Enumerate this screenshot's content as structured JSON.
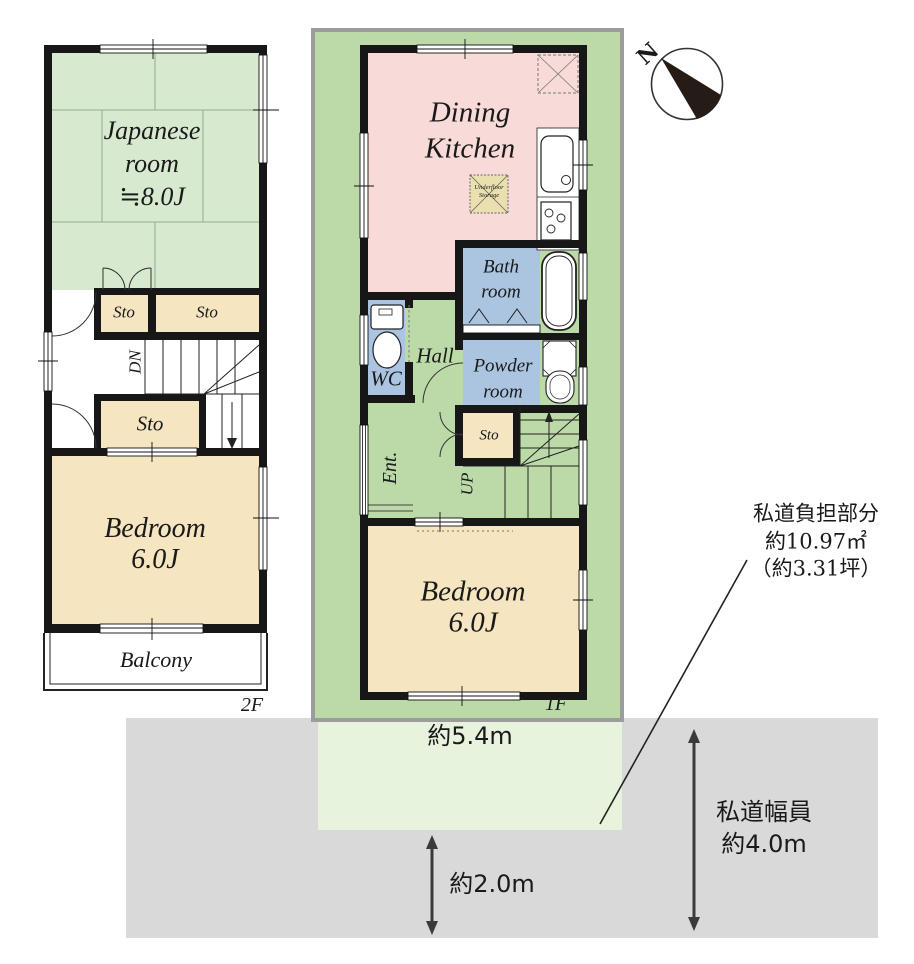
{
  "palette": {
    "tatami_green": "#d7e9cf",
    "lot_green": "#bcd9a8",
    "road_burden_green": "#e7f3dd",
    "room_tan": "#f5e5c1",
    "dining_pink": "#f8dbd8",
    "wet_area_blue": "#abc4e0",
    "road_gray": "#d9d9d9",
    "lot_border_gray": "#9c9c9c",
    "wall_black": "#171717"
  },
  "compass": {
    "north_label": "N"
  },
  "floor2": {
    "floor_label": "2F",
    "japanese_room": {
      "name_line1": "Japanese",
      "name_line2": "room",
      "size": "≒8.0J"
    },
    "storage_upper_left": "Sto",
    "storage_upper_right": "Sto",
    "storage_lower": "Sto",
    "stairs_down_label": "DN",
    "bedroom": {
      "name": "Bedroom",
      "size": "6.0J"
    },
    "balcony_label": "Balcony"
  },
  "floor1": {
    "floor_label": "1F",
    "dining_kitchen": {
      "name_line1": "Dining",
      "name_line2": "Kitchen"
    },
    "underfloor_storage": {
      "line1": "Underfloor",
      "line2": "Storage"
    },
    "bath_room": {
      "line1": "Bath",
      "line2": "room"
    },
    "wc_label": "WC",
    "hall_label": "Hall",
    "powder_room": {
      "line1": "Powder",
      "line2": "room"
    },
    "entrance_label": "Ent.",
    "stairs_up_label": "UP",
    "storage_label": "Sto",
    "bedroom": {
      "name": "Bedroom",
      "size": "6.0J"
    }
  },
  "site": {
    "frontage_label": "約5.4m",
    "setback_label": "約2.0m",
    "road_width_line1": "私道幅員",
    "road_width_line2": "約4.0m",
    "burden_line1": "私道負担部分",
    "burden_line2": "約10.97㎡",
    "burden_line3": "（約3.31坪）"
  }
}
